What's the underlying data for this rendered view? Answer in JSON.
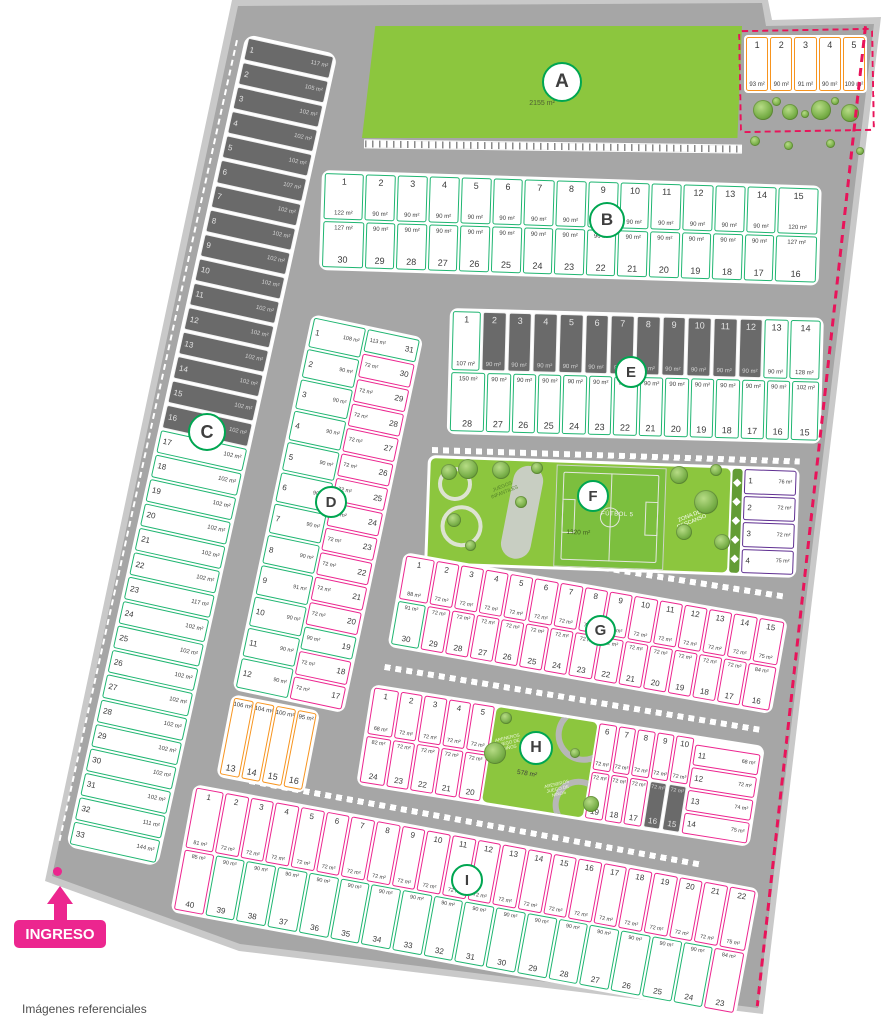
{
  "footer": {
    "note": "Imágenes referenciales"
  },
  "entrance": {
    "label": "INGRESO"
  },
  "colors": {
    "green": "#1fb571",
    "pink": "#ec268f",
    "orange": "#f7941e",
    "purple": "#5f2f91",
    "boundary": "#e8145a",
    "park": "#8cc63e",
    "sold": "#6a6a6a"
  },
  "top_right": {
    "lots": [
      {
        "n": "1",
        "a": "93 m²"
      },
      {
        "n": "2",
        "a": "90 m²"
      },
      {
        "n": "3",
        "a": "91 m²"
      },
      {
        "n": "4",
        "a": "90 m²"
      },
      {
        "n": "5",
        "a": "109 m²"
      }
    ]
  },
  "blocks": {
    "A": {
      "letter": "A",
      "area": "2155 m²"
    },
    "B": {
      "letter": "B",
      "row1": [
        {
          "n": "1",
          "a": "122 m²",
          "f": 1.35
        },
        {
          "n": "2",
          "a": "90 m²"
        },
        {
          "n": "3",
          "a": "90 m²"
        },
        {
          "n": "4",
          "a": "90 m²"
        },
        {
          "n": "5",
          "a": "90 m²"
        },
        {
          "n": "6",
          "a": "90 m²"
        },
        {
          "n": "7",
          "a": "90 m²"
        },
        {
          "n": "8",
          "a": "90 m²"
        },
        {
          "n": "9",
          "a": "90 m²"
        },
        {
          "n": "10",
          "a": "90 m²"
        },
        {
          "n": "11",
          "a": "90 m²"
        },
        {
          "n": "12",
          "a": "90 m²"
        },
        {
          "n": "13",
          "a": "90 m²"
        },
        {
          "n": "14",
          "a": "90 m²"
        },
        {
          "n": "15",
          "a": "120 m²",
          "f": 1.35
        }
      ],
      "row2": [
        {
          "n": "30",
          "a": "127 m²",
          "f": 1.4
        },
        {
          "n": "29",
          "a": "90 m²"
        },
        {
          "n": "28",
          "a": "90 m²"
        },
        {
          "n": "27",
          "a": "90 m²"
        },
        {
          "n": "26",
          "a": "90 m²"
        },
        {
          "n": "25",
          "a": "90 m²"
        },
        {
          "n": "24",
          "a": "90 m²"
        },
        {
          "n": "23",
          "a": "90 m²"
        },
        {
          "n": "22",
          "a": "90 m²"
        },
        {
          "n": "21",
          "a": "90 m²"
        },
        {
          "n": "20",
          "a": "90 m²"
        },
        {
          "n": "19",
          "a": "90 m²"
        },
        {
          "n": "18",
          "a": "90 m²"
        },
        {
          "n": "17",
          "a": "90 m²"
        },
        {
          "n": "16",
          "a": "127 m²",
          "f": 1.4
        }
      ]
    },
    "C": {
      "letter": "C",
      "lots": [
        {
          "n": "1",
          "a": "117 m²",
          "sold": true
        },
        {
          "n": "2",
          "a": "105 m²",
          "sold": true
        },
        {
          "n": "3",
          "a": "102 m²",
          "sold": true
        },
        {
          "n": "4",
          "a": "102 m²",
          "sold": true
        },
        {
          "n": "5",
          "a": "102 m²",
          "sold": true
        },
        {
          "n": "6",
          "a": "107 m²",
          "sold": true
        },
        {
          "n": "7",
          "a": "102 m²",
          "sold": true
        },
        {
          "n": "8",
          "a": "102 m²",
          "sold": true
        },
        {
          "n": "9",
          "a": "102 m²",
          "sold": true
        },
        {
          "n": "10",
          "a": "102 m²",
          "sold": true
        },
        {
          "n": "11",
          "a": "102 m²",
          "sold": true
        },
        {
          "n": "12",
          "a": "102 m²",
          "sold": true
        },
        {
          "n": "13",
          "a": "102 m²",
          "sold": true
        },
        {
          "n": "14",
          "a": "102 m²",
          "sold": true
        },
        {
          "n": "15",
          "a": "102 m²",
          "sold": true
        },
        {
          "n": "16",
          "a": "102 m²",
          "sold": true
        },
        {
          "n": "17",
          "a": "102 m²"
        },
        {
          "n": "18",
          "a": "102 m²"
        },
        {
          "n": "19",
          "a": "102 m²"
        },
        {
          "n": "20",
          "a": "102 m²"
        },
        {
          "n": "21",
          "a": "102 m²"
        },
        {
          "n": "22",
          "a": "102 m²"
        },
        {
          "n": "23",
          "a": "117 m²"
        },
        {
          "n": "24",
          "a": "102 m²"
        },
        {
          "n": "25",
          "a": "102 m²"
        },
        {
          "n": "26",
          "a": "102 m²"
        },
        {
          "n": "27",
          "a": "102 m²"
        },
        {
          "n": "28",
          "a": "102 m²"
        },
        {
          "n": "29",
          "a": "102 m²"
        },
        {
          "n": "30",
          "a": "102 m²"
        },
        {
          "n": "31",
          "a": "102 m²"
        },
        {
          "n": "32",
          "a": "111 m²"
        },
        {
          "n": "33",
          "a": "144 m²"
        }
      ]
    },
    "D": {
      "letter": "D",
      "left": [
        {
          "n": "1",
          "a": "108 m²"
        },
        {
          "n": "2",
          "a": "90 m²"
        },
        {
          "n": "3",
          "a": "90 m²"
        },
        {
          "n": "4",
          "a": "90 m²"
        },
        {
          "n": "5",
          "a": "90 m²"
        },
        {
          "n": "6",
          "a": "90 m²"
        },
        {
          "n": "7",
          "a": "90 m²"
        },
        {
          "n": "8",
          "a": "90 m²"
        },
        {
          "n": "9",
          "a": "91 m²"
        },
        {
          "n": "10",
          "a": "90 m²"
        },
        {
          "n": "11",
          "a": "90 m²"
        },
        {
          "n": "12",
          "a": "90 m²"
        }
      ],
      "right": [
        {
          "n": "31",
          "a": "113 m²",
          "c": "g"
        },
        {
          "n": "30",
          "a": "72 m²"
        },
        {
          "n": "29",
          "a": "72 m²"
        },
        {
          "n": "28",
          "a": "72 m²"
        },
        {
          "n": "27",
          "a": "72 m²"
        },
        {
          "n": "26",
          "a": "72 m²"
        },
        {
          "n": "25",
          "a": "72 m²"
        },
        {
          "n": "24",
          "a": "72 m²"
        },
        {
          "n": "23",
          "a": "72 m²"
        },
        {
          "n": "22",
          "a": "72 m²"
        },
        {
          "n": "21",
          "a": "72 m²"
        },
        {
          "n": "20",
          "a": "72 m²"
        },
        {
          "n": "19",
          "a": "90 m²",
          "c": "g"
        },
        {
          "n": "18",
          "a": "72 m²"
        },
        {
          "n": "17",
          "a": "72 m²"
        }
      ],
      "south": [
        {
          "n": "13",
          "a": "106 m²"
        },
        {
          "n": "14",
          "a": "104 m²"
        },
        {
          "n": "15",
          "a": "100 m²"
        },
        {
          "n": "16",
          "a": "95 m²"
        }
      ]
    },
    "E": {
      "letter": "E",
      "row1": [
        {
          "n": "1",
          "a": "107 m²",
          "f": 1.2
        },
        {
          "n": "2",
          "a": "90 m²",
          "sold": true
        },
        {
          "n": "3",
          "a": "90 m²",
          "sold": true
        },
        {
          "n": "4",
          "a": "90 m²",
          "sold": true
        },
        {
          "n": "5",
          "a": "90 m²",
          "sold": true
        },
        {
          "n": "6",
          "a": "90 m²",
          "sold": true
        },
        {
          "n": "7",
          "a": "90 m²",
          "sold": true
        },
        {
          "n": "8",
          "a": "90 m²",
          "sold": true
        },
        {
          "n": "9",
          "a": "90 m²",
          "sold": true
        },
        {
          "n": "10",
          "a": "90 m²",
          "sold": true
        },
        {
          "n": "11",
          "a": "90 m²",
          "sold": true
        },
        {
          "n": "12",
          "a": "90 m²",
          "sold": true
        },
        {
          "n": "13",
          "a": "90 m²"
        },
        {
          "n": "14",
          "a": "128 m²",
          "f": 1.3
        }
      ],
      "row2": [
        {
          "n": "28",
          "a": "150 m²",
          "f": 1.5
        },
        {
          "n": "27",
          "a": "90 m²"
        },
        {
          "n": "26",
          "a": "90 m²"
        },
        {
          "n": "25",
          "a": "90 m²"
        },
        {
          "n": "24",
          "a": "90 m²"
        },
        {
          "n": "23",
          "a": "90 m²"
        },
        {
          "n": "22",
          "a": "90 m²"
        },
        {
          "n": "21",
          "a": "90 m²"
        },
        {
          "n": "20",
          "a": "90 m²"
        },
        {
          "n": "19",
          "a": "90 m²"
        },
        {
          "n": "18",
          "a": "90 m²"
        },
        {
          "n": "17",
          "a": "90 m²"
        },
        {
          "n": "16",
          "a": "90 m²"
        },
        {
          "n": "15",
          "a": "102 m²",
          "f": 1.15
        }
      ]
    },
    "F": {
      "letter": "F",
      "area": "1320 m²",
      "field_label": "FÚTBOL 5",
      "zone_label": "ZONA DE DESCANSO",
      "park_label": "JUEGOS INFANTILES",
      "lots": [
        {
          "n": "1",
          "a": "76 m²"
        },
        {
          "n": "2",
          "a": "72 m²"
        },
        {
          "n": "3",
          "a": "72 m²"
        },
        {
          "n": "4",
          "a": "75 m²"
        }
      ]
    },
    "G": {
      "letter": "G",
      "row1": [
        {
          "n": "1",
          "a": "88 m²",
          "f": 1.25
        },
        {
          "n": "2",
          "a": "72 m²"
        },
        {
          "n": "3",
          "a": "72 m²"
        },
        {
          "n": "4",
          "a": "72 m²"
        },
        {
          "n": "5",
          "a": "72 m²"
        },
        {
          "n": "6",
          "a": "72 m²"
        },
        {
          "n": "7",
          "a": "72 m²"
        },
        {
          "n": "8",
          "a": "72 m²"
        },
        {
          "n": "9",
          "a": "72 m²"
        },
        {
          "n": "10",
          "a": "72 m²"
        },
        {
          "n": "11",
          "a": "72 m²"
        },
        {
          "n": "12",
          "a": "72 m²"
        },
        {
          "n": "13",
          "a": "72 m²"
        },
        {
          "n": "14",
          "a": "72 m²"
        },
        {
          "n": "15",
          "a": "75 m²",
          "f": 1.1
        }
      ],
      "row2": [
        {
          "n": "30",
          "a": "91 m²",
          "c": "g",
          "f": 1.25
        },
        {
          "n": "29",
          "a": "72 m²"
        },
        {
          "n": "28",
          "a": "72 m²"
        },
        {
          "n": "27",
          "a": "72 m²"
        },
        {
          "n": "26",
          "a": "72 m²"
        },
        {
          "n": "25",
          "a": "72 m²"
        },
        {
          "n": "24",
          "a": "72 m²"
        },
        {
          "n": "23",
          "a": "72 m²"
        },
        {
          "n": "22",
          "a": "72 m²"
        },
        {
          "n": "21",
          "a": "72 m²"
        },
        {
          "n": "20",
          "a": "72 m²"
        },
        {
          "n": "19",
          "a": "72 m²"
        },
        {
          "n": "18",
          "a": "72 m²"
        },
        {
          "n": "17",
          "a": "72 m²"
        },
        {
          "n": "16",
          "a": "84 m²",
          "f": 1.25
        }
      ]
    },
    "H": {
      "letter": "H",
      "area": "578 m²",
      "park_label": "ARENEROS JUEGO DE NIÑOS",
      "row1_left": [
        {
          "n": "1",
          "a": "68 m²",
          "f": 1.15
        },
        {
          "n": "2",
          "a": "72 m²"
        },
        {
          "n": "3",
          "a": "72 m²"
        },
        {
          "n": "4",
          "a": "72 m²"
        },
        {
          "n": "5",
          "a": "72 m²"
        }
      ],
      "row1_right": [
        {
          "n": "6",
          "a": "72 m²"
        },
        {
          "n": "7",
          "a": "72 m²"
        },
        {
          "n": "8",
          "a": "72 m²"
        },
        {
          "n": "9",
          "a": "72 m²"
        },
        {
          "n": "10",
          "a": "72 m²"
        }
      ],
      "east": [
        {
          "n": "11",
          "a": "68 m²"
        },
        {
          "n": "12",
          "a": "72 m²"
        },
        {
          "n": "13",
          "a": "74 m²"
        },
        {
          "n": "14",
          "a": "75 m²"
        }
      ],
      "row2_left": [
        {
          "n": "24",
          "a": "82 m²",
          "f": 1.15
        },
        {
          "n": "23",
          "a": "72 m²"
        },
        {
          "n": "22",
          "a": "72 m²"
        },
        {
          "n": "21",
          "a": "72 m²"
        },
        {
          "n": "20",
          "a": "72 m²"
        }
      ],
      "row2_right": [
        {
          "n": "19",
          "a": "72 m²"
        },
        {
          "n": "18",
          "a": "72 m²"
        },
        {
          "n": "17",
          "a": "72 m²"
        },
        {
          "n": "16",
          "a": "72 m²",
          "sold": true
        },
        {
          "n": "15",
          "a": "72 m²",
          "sold": true
        }
      ]
    },
    "I": {
      "letter": "I",
      "row1": [
        {
          "n": "1",
          "a": "81 m²",
          "f": 1.2
        },
        {
          "n": "2",
          "a": "72 m²"
        },
        {
          "n": "3",
          "a": "72 m²"
        },
        {
          "n": "4",
          "a": "72 m²"
        },
        {
          "n": "5",
          "a": "72 m²"
        },
        {
          "n": "6",
          "a": "72 m²"
        },
        {
          "n": "7",
          "a": "72 m²"
        },
        {
          "n": "8",
          "a": "72 m²"
        },
        {
          "n": "9",
          "a": "72 m²"
        },
        {
          "n": "10",
          "a": "72 m²"
        },
        {
          "n": "11",
          "a": "72 m²"
        },
        {
          "n": "12",
          "a": "72 m²"
        },
        {
          "n": "13",
          "a": "72 m²"
        },
        {
          "n": "14",
          "a": "72 m²"
        },
        {
          "n": "15",
          "a": "72 m²"
        },
        {
          "n": "16",
          "a": "72 m²"
        },
        {
          "n": "17",
          "a": "72 m²"
        },
        {
          "n": "18",
          "a": "72 m²"
        },
        {
          "n": "19",
          "a": "72 m²"
        },
        {
          "n": "20",
          "a": "72 m²"
        },
        {
          "n": "21",
          "a": "72 m²"
        },
        {
          "n": "22",
          "a": "75 m²",
          "f": 1.1
        }
      ],
      "row2": [
        {
          "n": "40",
          "a": "85 m²",
          "c": "p"
        },
        {
          "n": "39",
          "a": "90 m²"
        },
        {
          "n": "38",
          "a": "90 m²"
        },
        {
          "n": "37",
          "a": "90 m²"
        },
        {
          "n": "36",
          "a": "90 m²"
        },
        {
          "n": "35",
          "a": "90 m²"
        },
        {
          "n": "34",
          "a": "90 m²"
        },
        {
          "n": "33",
          "a": "90 m²"
        },
        {
          "n": "32",
          "a": "90 m²"
        },
        {
          "n": "31",
          "a": "90 m²"
        },
        {
          "n": "30",
          "a": "90 m²"
        },
        {
          "n": "29",
          "a": "90 m²"
        },
        {
          "n": "28",
          "a": "90 m²"
        },
        {
          "n": "27",
          "a": "90 m²"
        },
        {
          "n": "26",
          "a": "90 m²"
        },
        {
          "n": "25",
          "a": "90 m²"
        },
        {
          "n": "24",
          "a": "90 m²"
        },
        {
          "n": "23",
          "a": "84 m²",
          "c": "p"
        }
      ]
    }
  }
}
